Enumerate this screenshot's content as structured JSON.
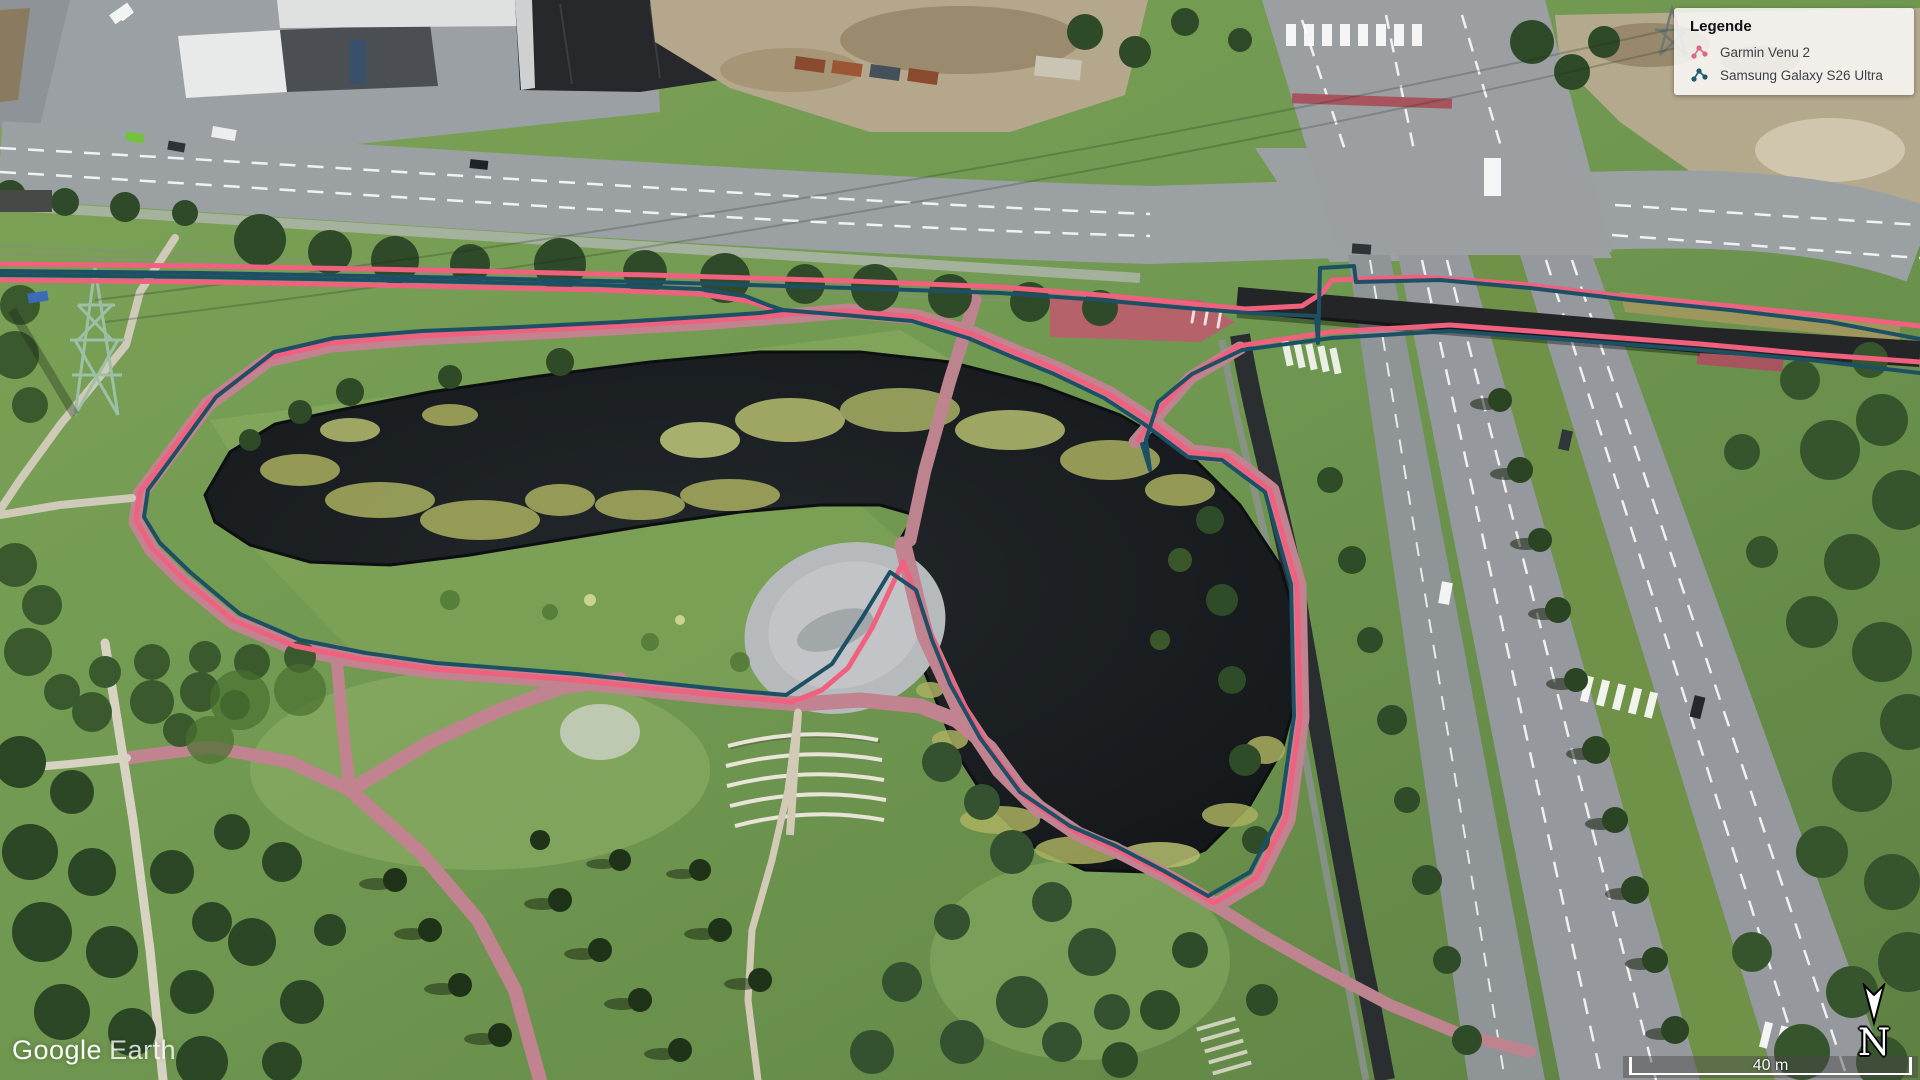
{
  "window": {
    "width": 1920,
    "height": 1080
  },
  "map": {
    "type": "satellite",
    "description": "Google Earth aerial view of a park pond with two overlaid GPS running tracks"
  },
  "legend": {
    "title": "Legende",
    "items": [
      {
        "id": "garmin",
        "label": "Garmin Venu 2",
        "icon": "track-nodes-icon",
        "icon_color": "#d96a80"
      },
      {
        "id": "samsung",
        "label": "Samsung Galaxy S26 Ultra",
        "icon": "track-nodes-icon",
        "icon_color": "#1d5a6b"
      }
    ]
  },
  "attribution": {
    "brand": "Google",
    "product": "Earth"
  },
  "scale_bar": {
    "label": "40 m"
  },
  "compass": {
    "label": "N"
  },
  "overlay": {
    "tracks": [
      {
        "id": "garmin-venu-2",
        "name": "Garmin Venu 2",
        "color": "#f0617f",
        "width": 5,
        "segments": [
          [
            [
              0,
              264
            ],
            [
              200,
              266
            ],
            [
              420,
              270
            ],
            [
              650,
              275
            ],
            [
              850,
              281
            ],
            [
              1000,
              287
            ],
            [
              1100,
              295
            ],
            [
              1175,
              302
            ],
            [
              1245,
              309
            ],
            [
              1302,
              306
            ],
            [
              1322,
              293
            ],
            [
              1332,
              280
            ],
            [
              1420,
              277
            ],
            [
              1520,
              284
            ],
            [
              1620,
              296
            ],
            [
              1730,
              306
            ],
            [
              1830,
              316
            ],
            [
              1920,
              326
            ]
          ],
          [
            [
              0,
              280
            ],
            [
              200,
              282
            ],
            [
              420,
              286
            ],
            [
              600,
              290
            ],
            [
              700,
              294
            ],
            [
              748,
              301
            ],
            [
              772,
              309
            ],
            [
              790,
              314
            ],
            [
              762,
              317
            ],
            [
              700,
              321
            ],
            [
              620,
              326
            ],
            [
              520,
              331
            ],
            [
              420,
              336
            ],
            [
              332,
              343
            ],
            [
              268,
              358
            ],
            [
              208,
              402
            ],
            [
              168,
              455
            ],
            [
              140,
              492
            ],
            [
              136,
              520
            ],
            [
              152,
              548
            ],
            [
              182,
              578
            ],
            [
              233,
              620
            ],
            [
              295,
              646
            ],
            [
              360,
              659
            ],
            [
              432,
              669
            ],
            [
              512,
              675
            ],
            [
              575,
              680
            ],
            [
              650,
              688
            ],
            [
              726,
              696
            ],
            [
              792,
              702
            ],
            [
              822,
              690
            ],
            [
              848,
              668
            ],
            [
              872,
              628
            ],
            [
              903,
              562
            ],
            [
              922,
              610
            ],
            [
              938,
              652
            ],
            [
              956,
              690
            ],
            [
              986,
              744
            ],
            [
              1026,
              798
            ],
            [
              1076,
              832
            ],
            [
              1122,
              852
            ],
            [
              1170,
              877
            ],
            [
              1214,
              903
            ],
            [
              1256,
              878
            ],
            [
              1286,
              818
            ],
            [
              1300,
              718
            ],
            [
              1297,
              585
            ],
            [
              1270,
              490
            ],
            [
              1226,
              456
            ],
            [
              1190,
              452
            ],
            [
              1148,
              420
            ],
            [
              1108,
              394
            ],
            [
              1058,
              370
            ],
            [
              1014,
              352
            ],
            [
              972,
              334
            ],
            [
              916,
              317
            ],
            [
              846,
              311
            ],
            [
              790,
              314
            ]
          ],
          [
            [
              1138,
              440
            ],
            [
              1154,
              416
            ],
            [
              1188,
              378
            ],
            [
              1238,
              346
            ],
            [
              1330,
              332
            ],
            [
              1450,
              325
            ],
            [
              1570,
              334
            ],
            [
              1700,
              344
            ],
            [
              1810,
              354
            ],
            [
              1920,
              362
            ]
          ]
        ]
      },
      {
        "id": "samsung-galaxy-s26-ultra",
        "name": "Samsung Galaxy S26 Ultra",
        "color": "#1d5065",
        "width": 4,
        "segments": [
          [
            [
              0,
              271
            ],
            [
              200,
              273
            ],
            [
              420,
              277
            ],
            [
              650,
              282
            ],
            [
              850,
              288
            ],
            [
              1000,
              293
            ],
            [
              1100,
              300
            ],
            [
              1175,
              307
            ],
            [
              1248,
              313
            ],
            [
              1316,
              316
            ],
            [
              1318,
              343
            ],
            [
              1320,
              268
            ],
            [
              1354,
              266
            ],
            [
              1356,
              282
            ],
            [
              1440,
              280
            ],
            [
              1530,
              288
            ],
            [
              1630,
              300
            ],
            [
              1730,
              310
            ],
            [
              1830,
              322
            ],
            [
              1920,
              339
            ]
          ],
          [
            [
              0,
              275
            ],
            [
              200,
              277
            ],
            [
              420,
              281
            ],
            [
              600,
              285
            ],
            [
              700,
              289
            ],
            [
              745,
              296
            ],
            [
              768,
              305
            ],
            [
              783,
              310
            ],
            [
              760,
              313
            ],
            [
              700,
              317
            ],
            [
              620,
              322
            ],
            [
              520,
              327
            ],
            [
              422,
              331
            ],
            [
              334,
              338
            ],
            [
              274,
              352
            ],
            [
              216,
              397
            ],
            [
              176,
              452
            ],
            [
              148,
              490
            ],
            [
              144,
              517
            ],
            [
              160,
              543
            ],
            [
              190,
              572
            ],
            [
              240,
              614
            ],
            [
              300,
              640
            ],
            [
              366,
              653
            ],
            [
              436,
              663
            ],
            [
              514,
              669
            ],
            [
              578,
              674
            ],
            [
              652,
              682
            ],
            [
              728,
              690
            ],
            [
              786,
              695
            ],
            [
              832,
              664
            ],
            [
              862,
              618
            ],
            [
              890,
              572
            ],
            [
              916,
              590
            ],
            [
              932,
              640
            ],
            [
              950,
              684
            ],
            [
              980,
              738
            ],
            [
              1020,
              792
            ],
            [
              1070,
              826
            ],
            [
              1116,
              846
            ],
            [
              1164,
              871
            ],
            [
              1208,
              896
            ],
            [
              1250,
              872
            ],
            [
              1280,
              814
            ],
            [
              1294,
              716
            ],
            [
              1291,
              584
            ],
            [
              1265,
              492
            ],
            [
              1222,
              460
            ],
            [
              1188,
              457
            ],
            [
              1144,
              424
            ],
            [
              1104,
              398
            ],
            [
              1054,
              374
            ],
            [
              1010,
              356
            ],
            [
              968,
              338
            ],
            [
              912,
              321
            ],
            [
              844,
              315
            ],
            [
              783,
              310
            ]
          ],
          [
            [
              1142,
              444
            ],
            [
              1150,
              470
            ],
            [
              1146,
              440
            ],
            [
              1158,
              402
            ],
            [
              1192,
              374
            ],
            [
              1242,
              350
            ],
            [
              1332,
              338
            ],
            [
              1450,
              331
            ],
            [
              1570,
              340
            ],
            [
              1700,
              350
            ],
            [
              1810,
              360
            ],
            [
              1920,
              373
            ]
          ]
        ]
      }
    ]
  }
}
